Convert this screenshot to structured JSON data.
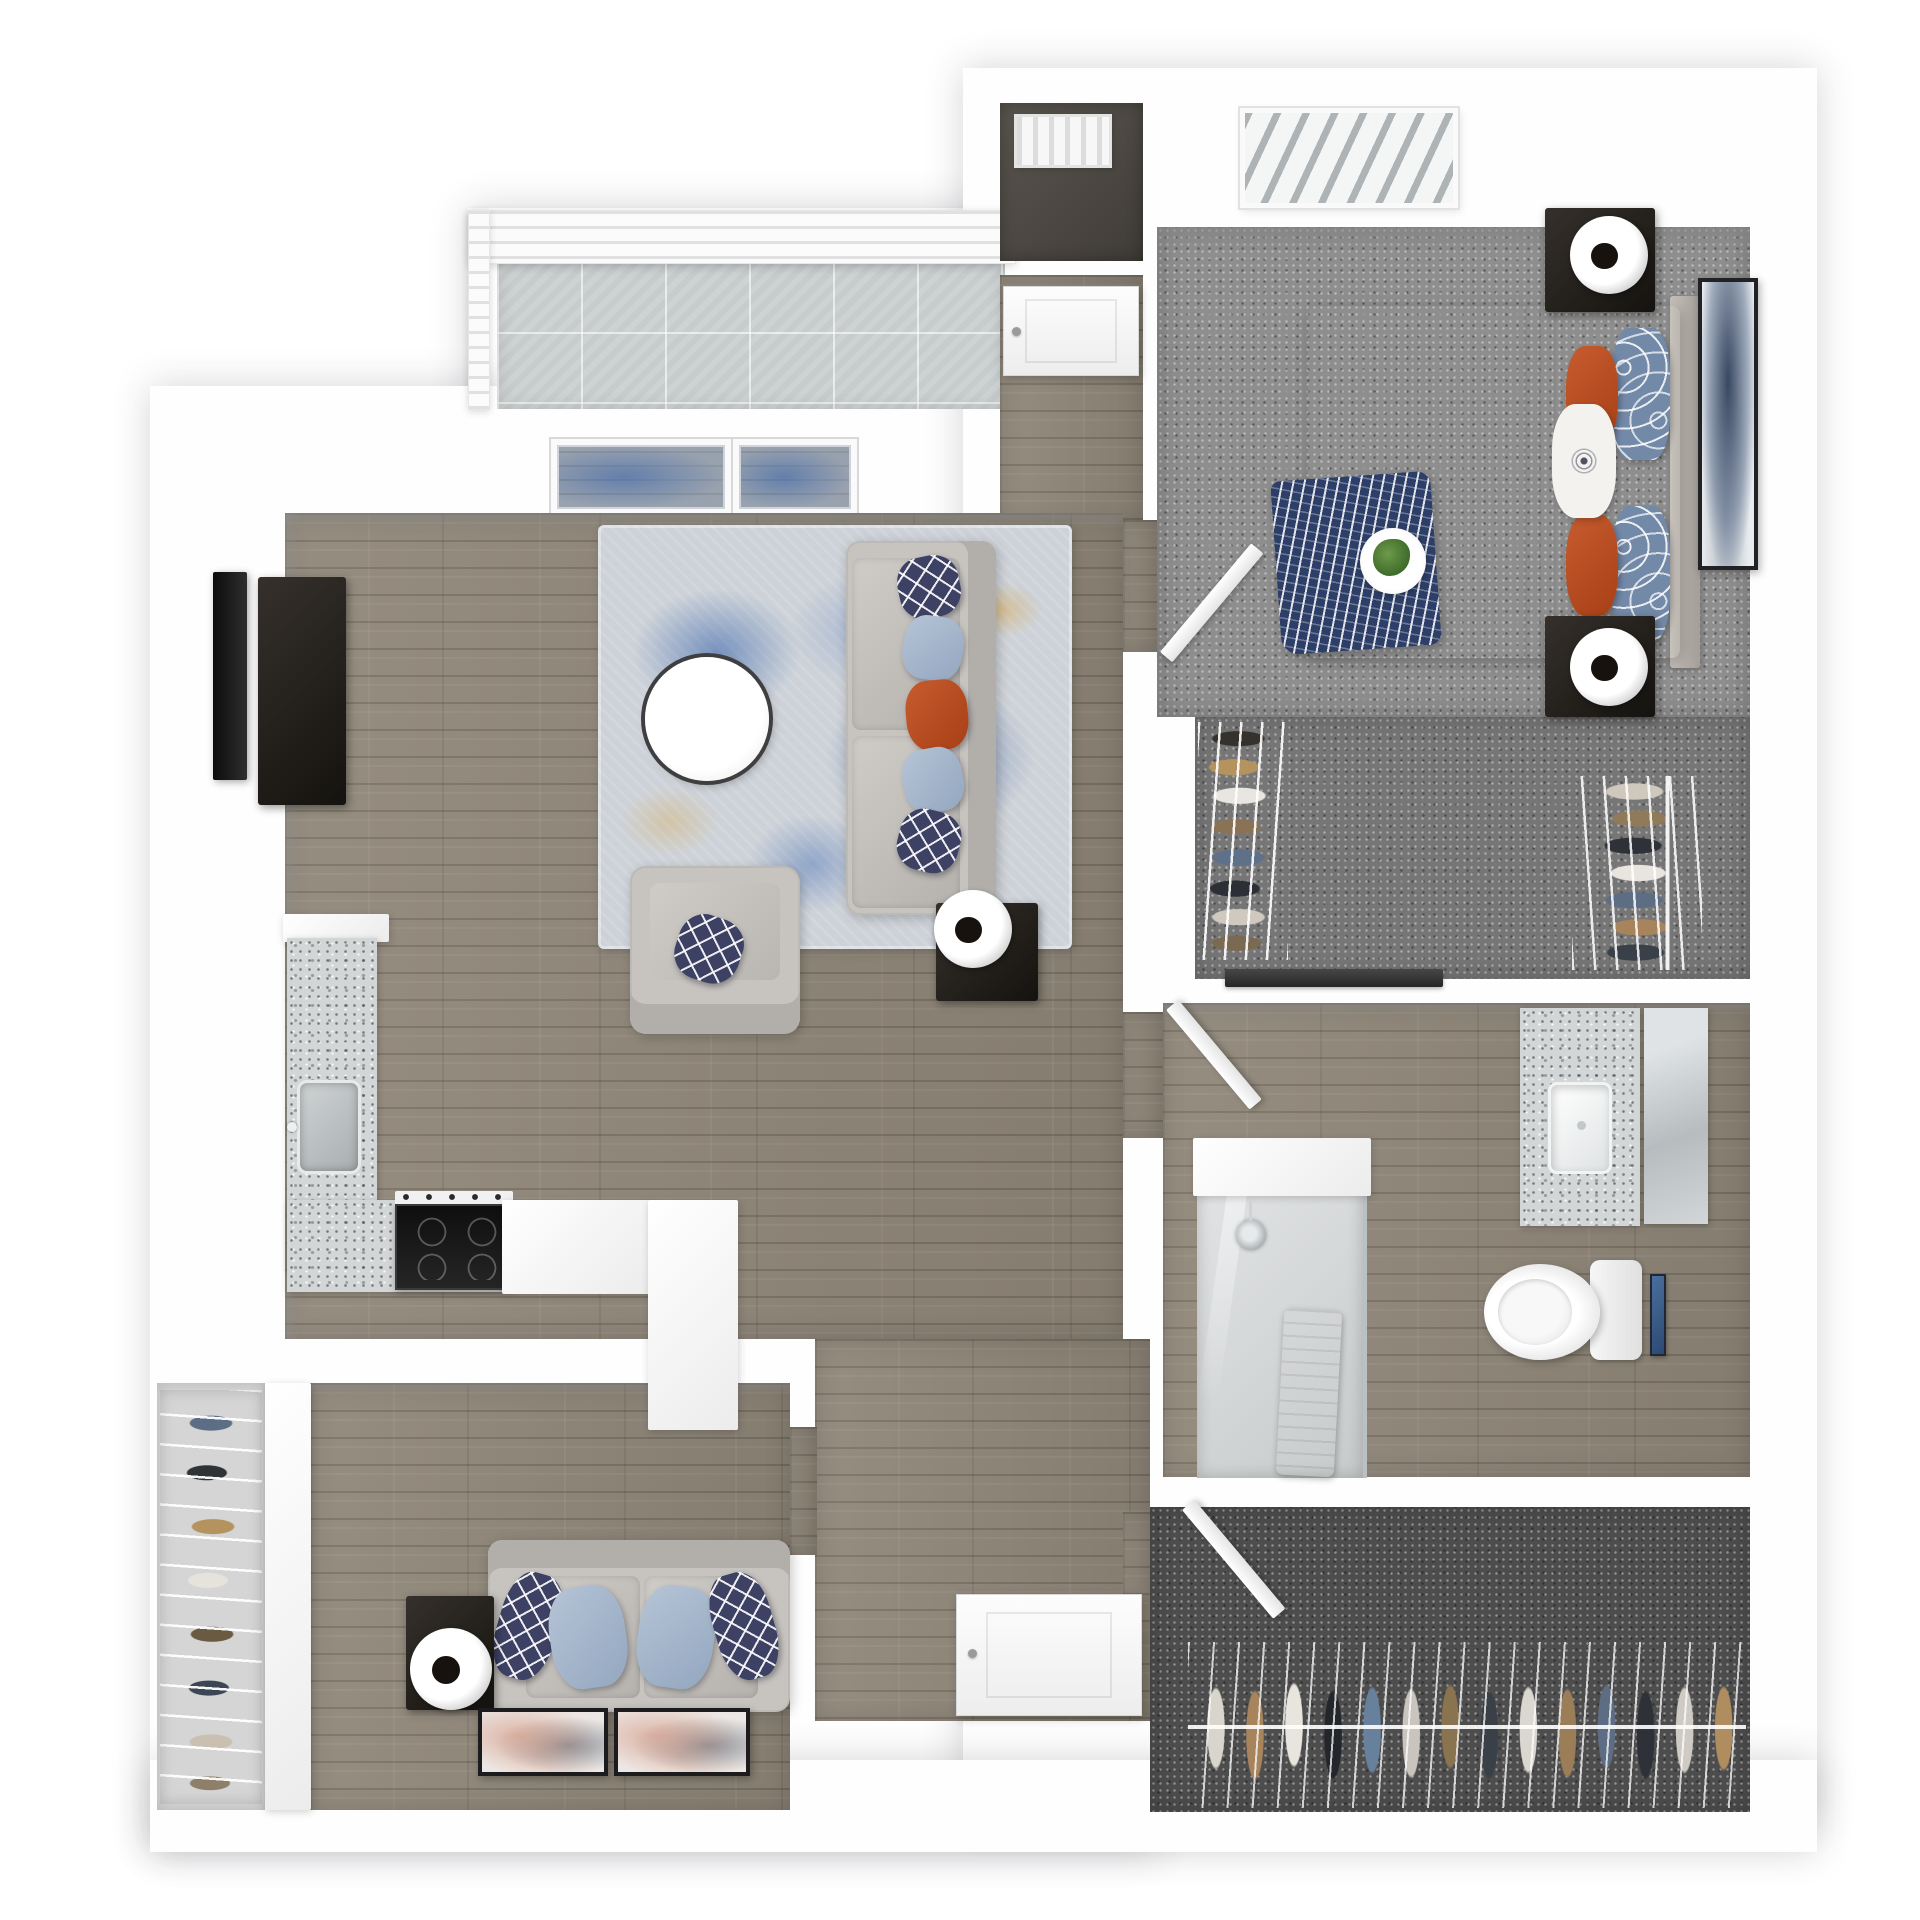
{
  "scene": {
    "kind": "3d-floor-plan-render",
    "description": "Top-down 3D rendering of a one-bedroom apartment floor plan with balcony, living room, kitchen, den, bedroom, walk-in closets and bathroom. No text labels are rendered in the image.",
    "canvas": {
      "width": 1920,
      "height": 1920,
      "background": "#ffffff"
    }
  },
  "palette": {
    "wall": "#fefefe",
    "wood_floor": "#8f8678",
    "carpet_bedroom": "#8e8e8e",
    "carpet_closet": "#767676",
    "carpet_dark_closet": "#4d4d4d",
    "balcony_concrete": "#cdd2d3",
    "granite_counter": "#d3d6d7",
    "accent_navy": "#3d4163",
    "accent_light_blue": "#a9bcd4",
    "accent_orange": "#c0502a",
    "rug_blue": "#2f5da8",
    "rug_gold": "#d9a94e",
    "dark_furniture": "#1f1b17"
  },
  "blocks": [
    {
      "name": "balcony-structure",
      "cls": "block",
      "x": 468,
      "y": 208,
      "w": 548,
      "h": 208
    },
    {
      "name": "left-wing-walls",
      "cls": "block",
      "x": 150,
      "y": 386,
      "w": 1008,
      "h": 1464
    },
    {
      "name": "right-wing-walls",
      "cls": "block",
      "x": 963,
      "y": 68,
      "w": 854,
      "h": 1752
    },
    {
      "name": "bottom-walls",
      "cls": "block",
      "x": 150,
      "y": 1760,
      "w": 1667,
      "h": 92
    }
  ],
  "rooms": [
    {
      "name": "balcony-floor",
      "cls": "concrete",
      "x": 497,
      "y": 262,
      "w": 508,
      "h": 147
    },
    {
      "name": "balcony-railing",
      "cls": "railing",
      "x": 468,
      "y": 210,
      "w": 548,
      "h": 54
    },
    {
      "name": "balcony-side-railing",
      "cls": "railing",
      "x": 468,
      "y": 210,
      "w": 22,
      "h": 200
    },
    {
      "name": "living-window-1",
      "cls": "window",
      "x": 551,
      "y": 439,
      "w": 180,
      "h": 76
    },
    {
      "name": "living-window-2",
      "cls": "window",
      "x": 733,
      "y": 439,
      "w": 124,
      "h": 76
    },
    {
      "name": "laundry-closet-floor",
      "cls": "darkfloor",
      "x": 1000,
      "y": 103,
      "w": 143,
      "h": 158
    },
    {
      "name": "laundry-vent",
      "cls": "vent",
      "x": 1014,
      "y": 114,
      "w": 98,
      "h": 54
    },
    {
      "name": "entry-hall-floor",
      "cls": "wood",
      "x": 1000,
      "y": 275,
      "w": 143,
      "h": 248
    },
    {
      "name": "living-room-floor",
      "cls": "wood",
      "x": 285,
      "y": 513,
      "w": 838,
      "h": 826
    },
    {
      "name": "hallway-floor",
      "cls": "wood",
      "x": 815,
      "y": 1339,
      "w": 335,
      "h": 382
    },
    {
      "name": "bedroom-doorway-floor",
      "cls": "wood",
      "x": 1123,
      "y": 520,
      "w": 36,
      "h": 132
    },
    {
      "name": "bathroom-doorway-floor",
      "cls": "wood",
      "x": 1123,
      "y": 1012,
      "w": 42,
      "h": 126
    },
    {
      "name": "closet2-doorway-floor",
      "cls": "wood",
      "x": 1123,
      "y": 1512,
      "w": 29,
      "h": 132
    },
    {
      "name": "den-doorway-floor",
      "cls": "wood",
      "x": 790,
      "y": 1427,
      "w": 27,
      "h": 128
    },
    {
      "name": "bedroom-floor",
      "cls": "carpet",
      "x": 1157,
      "y": 227,
      "w": 593,
      "h": 490
    },
    {
      "name": "bedroom-window-blinds",
      "cls": "slatwin",
      "x": 1240,
      "y": 108,
      "w": 218,
      "h": 100
    },
    {
      "name": "walkin-closet-floor",
      "c ls": "",
      "cls": "carpet-mid",
      "x": 1195,
      "y": 717,
      "w": 555,
      "h": 262
    },
    {
      "name": "bathroom-floor",
      "cls": "wood",
      "x": 1163,
      "y": 1003,
      "w": 587,
      "h": 474
    },
    {
      "name": "closet2-floor",
      "cls": "carpet-dark",
      "x": 1150,
      "y": 1507,
      "w": 600,
      "h": 305
    },
    {
      "name": "den-floor",
      "cls": "wood",
      "x": 310,
      "y": 1383,
      "w": 480,
      "h": 427
    },
    {
      "name": "den-closet-floor",
      "cls": "lightfloor",
      "x": 157,
      "y": 1383,
      "w": 108,
      "h": 427
    },
    {
      "name": "living-north-wallface",
      "cls": "wallface",
      "x": 285,
      "y": 513,
      "w": 838,
      "h": 16
    },
    {
      "name": "bedroom-north-wallface",
      "cls": "wallface",
      "x": 1157,
      "y": 227,
      "w": 593,
      "h": 26
    },
    {
      "name": "den-north-wallface",
      "cls": "wallface",
      "x": 310,
      "y": 1383,
      "w": 480,
      "h": 13
    },
    {
      "name": "bathroom-north-wallface",
      "cls": "wallface",
      "x": 1163,
      "y": 1003,
      "w": 587,
      "h": 11
    },
    {
      "name": "living-west-wallface",
      "cls": "wallface-v",
      "x": 285,
      "y": 513,
      "w": 15,
      "h": 826
    }
  ],
  "furniture": [
    {
      "name": "tv",
      "cls": "tv",
      "x": 213,
      "y": 572,
      "w": 34,
      "h": 208
    },
    {
      "name": "media-console",
      "cls": "dark-cab",
      "x": 258,
      "y": 577,
      "w": 88,
      "h": 228
    },
    {
      "name": "area-rug",
      "cls": "rug-blue",
      "x": 598,
      "y": 525,
      "w": 474,
      "h": 424
    },
    {
      "name": "coffee-table",
      "cls": "circle-table",
      "x": 645,
      "y": 657,
      "w": 124,
      "h": 124
    },
    {
      "name": "sofa",
      "cls": "sofa-v",
      "x": 846,
      "y": 541,
      "w": 150,
      "h": 374
    },
    {
      "name": "sofa-cushion-1",
      "cls": "cushion",
      "x": 852,
      "y": 558,
      "w": 108,
      "h": 172
    },
    {
      "name": "sofa-cushion-2",
      "cls": "cushion",
      "x": 852,
      "y": 736,
      "w": 108,
      "h": 172
    },
    {
      "name": "sofa-pillow-navy-1",
      "cls": "pillow-navy",
      "x": 898,
      "y": 556,
      "w": 62,
      "h": 62,
      "rot": -12
    },
    {
      "name": "sofa-pillow-blue-1",
      "cls": "pillow-blue",
      "x": 903,
      "y": 616,
      "w": 60,
      "h": 64,
      "rot": 8
    },
    {
      "name": "sofa-pillow-orange",
      "cls": "pillow-orange",
      "x": 906,
      "y": 680,
      "w": 62,
      "h": 70,
      "rot": -5
    },
    {
      "name": "sofa-pillow-blue-2",
      "cls": "pillow-blue",
      "x": 903,
      "y": 748,
      "w": 60,
      "h": 64,
      "rot": -10
    },
    {
      "name": "sofa-pillow-navy-2",
      "cls": "pillow-navy",
      "x": 898,
      "y": 810,
      "w": 62,
      "h": 62,
      "rot": 14
    },
    {
      "name": "sofa-side-table",
      "cls": "dark-cab",
      "x": 936,
      "y": 903,
      "w": 102,
      "h": 98
    },
    {
      "name": "sofa-lamp",
      "cls": "lamp",
      "x": 934,
      "y": 890,
      "w": 78,
      "h": 78
    },
    {
      "name": "armchair",
      "cls": "armchair",
      "x": 630,
      "y": 866,
      "w": 170,
      "h": 168
    },
    {
      "name": "armchair-pillow",
      "cls": "pillow-navy",
      "x": 676,
      "y": 916,
      "w": 66,
      "h": 66,
      "rot": 18
    },
    {
      "name": "kitchen-counter-cap",
      "cls": "white-block",
      "x": 283,
      "y": 914,
      "w": 106,
      "h": 28
    },
    {
      "name": "kitchen-counter-west",
      "cls": "granite",
      "x": 287,
      "y": 938,
      "w": 90,
      "h": 332
    },
    {
      "name": "kitchen-sink",
      "cls": "sink-steel",
      "x": 297,
      "y": 1080,
      "w": 64,
      "h": 94
    },
    {
      "name": "kitchen-counter-south",
      "cls": "granite",
      "x": 287,
      "y": 1200,
      "w": 215,
      "h": 92
    },
    {
      "name": "kitchen-stove",
      "cls": "stove",
      "x": 395,
      "y": 1204,
      "w": 118,
      "h": 86
    },
    {
      "name": "kitchen-counter-white",
      "cls": "white-block",
      "x": 502,
      "y": 1200,
      "w": 148,
      "h": 94
    },
    {
      "name": "kitchen-peninsula",
      "cls": "white-block",
      "x": 648,
      "y": 1200,
      "w": 90,
      "h": 230
    },
    {
      "name": "bed-headboard",
      "cls": "headboard",
      "x": 1670,
      "y": 296,
      "w": 30,
      "h": 372
    },
    {
      "name": "bed",
      "cls": "bed",
      "x": 1308,
      "y": 306,
      "w": 372,
      "h": 352
    },
    {
      "name": "bed-throw-blanket",
      "cls": "throw-navy",
      "x": 1276,
      "y": 476,
      "w": 160,
      "h": 174,
      "rot": -4
    },
    {
      "name": "bed-breakfast-tray",
      "cls": "tray",
      "x": 1360,
      "y": 528,
      "w": 66,
      "h": 66
    },
    {
      "name": "bed-pillow-bluepat-1",
      "cls": "pillow-bluepat",
      "x": 1612,
      "y": 328,
      "w": 58,
      "h": 132
    },
    {
      "name": "bed-pillow-bluepat-2",
      "cls": "pillow-bluepat",
      "x": 1612,
      "y": 506,
      "w": 58,
      "h": 136
    },
    {
      "name": "bed-pillow-orange-1",
      "cls": "pillow-orange",
      "x": 1566,
      "y": 346,
      "w": 52,
      "h": 98
    },
    {
      "name": "bed-pillow-orange-2",
      "cls": "pillow-orange",
      "x": 1566,
      "y": 514,
      "w": 52,
      "h": 102
    },
    {
      "name": "bed-pillow-mandala",
      "cls": "pillow-white",
      "x": 1552,
      "y": 404,
      "w": 64,
      "h": 114
    },
    {
      "name": "nightstand-1",
      "cls": "dark-cab",
      "x": 1545,
      "y": 208,
      "w": 110,
      "h": 104
    },
    {
      "name": "nightstand-2",
      "cls": "dark-cab",
      "x": 1545,
      "y": 616,
      "w": 110,
      "h": 101
    },
    {
      "name": "nightstand-lamp-1",
      "cls": "lamp",
      "x": 1570,
      "y": 216,
      "w": 78,
      "h": 78
    },
    {
      "name": "nightstand-lamp-2",
      "cls": "lamp",
      "x": 1570,
      "y": 628,
      "w": 78,
      "h": 78
    },
    {
      "name": "bedroom-wall-art",
      "cls": "art-navy",
      "x": 1698,
      "y": 278,
      "w": 60,
      "h": 292
    },
    {
      "name": "bedroom-door",
      "cls": "door-leaf hinge-bl",
      "x": 1160,
      "y": 510,
      "w": 16,
      "h": 142,
      "rot": 40
    },
    {
      "name": "walkin-rack-west",
      "cls": "clothes-left",
      "x": 1198,
      "y": 722,
      "w": 90,
      "h": 238
    },
    {
      "name": "walkin-rack-east",
      "cls": "clothes-right",
      "x": 1572,
      "y": 776,
      "w": 130,
      "h": 194
    },
    {
      "name": "walkin-door-track",
      "cls": "bar-dark",
      "x": 1225,
      "y": 969,
      "w": 218,
      "h": 18
    },
    {
      "name": "bathroom-door",
      "cls": "door-leaf",
      "x": 1166,
      "y": 1010,
      "w": 16,
      "h": 130,
      "rot": -40
    },
    {
      "name": "vanity-counter",
      "cls": "granite",
      "x": 1520,
      "y": 1008,
      "w": 120,
      "h": 218
    },
    {
      "name": "vanity-sink",
      "cls": "sink-white",
      "x": 1548,
      "y": 1082,
      "w": 64,
      "h": 92
    },
    {
      "name": "vanity-mirror",
      "cls": "mirror",
      "x": 1644,
      "y": 1008,
      "w": 64,
      "h": 216
    },
    {
      "name": "toilet-tank",
      "cls": "toilet-tank",
      "x": 1590,
      "y": 1260,
      "w": 52,
      "h": 100
    },
    {
      "name": "toilet-bowl",
      "cls": "toilet-bowl",
      "x": 1484,
      "y": 1264,
      "w": 116,
      "h": 96
    },
    {
      "name": "bathroom-wall-art",
      "cls": "art-small",
      "x": 1650,
      "y": 1274,
      "w": 16,
      "h": 82
    },
    {
      "name": "shower",
      "cls": "shower-floor",
      "x": 1197,
      "y": 1150,
      "w": 170,
      "h": 328
    },
    {
      "name": "shower-halfwall",
      "cls": "white-block",
      "x": 1193,
      "y": 1138,
      "w": 178,
      "h": 58
    },
    {
      "name": "shower-head",
      "cls": "showerhead",
      "x": 1236,
      "y": 1220,
      "w": 30,
      "h": 30
    },
    {
      "name": "shower-towel",
      "cls": "towel",
      "x": 1280,
      "y": 1310,
      "w": 58,
      "h": 166,
      "rot": 3
    },
    {
      "name": "closet2-door",
      "cls": "door-leaf",
      "x": 1182,
      "y": 1510,
      "w": 16,
      "h": 142,
      "rot": -40
    },
    {
      "name": "closet2-clothes",
      "cls": "clothes-bottom",
      "x": 1188,
      "y": 1642,
      "w": 558,
      "h": 166
    },
    {
      "name": "den-closet-clothes",
      "cls": "clothes-den",
      "x": 160,
      "y": 1390,
      "w": 102,
      "h": 414
    },
    {
      "name": "den-closet-door-panel",
      "cls": "white-block",
      "x": 265,
      "y": 1383,
      "w": 46,
      "h": 427
    },
    {
      "name": "loveseat",
      "cls": "sofa-h",
      "x": 488,
      "y": 1540,
      "w": 302,
      "h": 172
    },
    {
      "name": "loveseat-cushion-1",
      "cls": "cushion",
      "x": 526,
      "y": 1576,
      "w": 114,
      "h": 122
    },
    {
      "name": "loveseat-cushion-2",
      "cls": "cushion",
      "x": 644,
      "y": 1576,
      "w": 114,
      "h": 122
    },
    {
      "name": "loveseat-pillow-navy-1",
      "cls": "pillow-navy",
      "x": 498,
      "y": 1572,
      "w": 60,
      "h": 108,
      "rot": 16
    },
    {
      "name": "loveseat-pillow-blue-1",
      "cls": "pillow-blue",
      "x": 550,
      "y": 1586,
      "w": 76,
      "h": 102,
      "rot": -8
    },
    {
      "name": "loveseat-pillow-blue-2",
      "cls": "pillow-blue",
      "x": 638,
      "y": 1586,
      "w": 76,
      "h": 102,
      "rot": 8
    },
    {
      "name": "loveseat-pillow-navy-2",
      "cls": "pillow-navy",
      "x": 714,
      "y": 1572,
      "w": 60,
      "h": 108,
      "rot": -16
    },
    {
      "name": "den-side-cube",
      "cls": "dark-cab",
      "x": 406,
      "y": 1596,
      "w": 88,
      "h": 114
    },
    {
      "name": "den-lamp",
      "cls": "lamp",
      "x": 410,
      "y": 1628,
      "w": 82,
      "h": 82
    },
    {
      "name": "den-art-1",
      "cls": "art-blush",
      "x": 478,
      "y": 1708,
      "w": 130,
      "h": 68
    },
    {
      "name": "den-art-2",
      "cls": "art-blush",
      "x": 614,
      "y": 1708,
      "w": 136,
      "h": 68
    },
    {
      "name": "entry-door",
      "cls": "door-flat",
      "x": 1003,
      "y": 286,
      "w": 136,
      "h": 90
    },
    {
      "name": "front-door",
      "cls": "door-flat",
      "x": 956,
      "y": 1594,
      "w": 186,
      "h": 122
    }
  ]
}
